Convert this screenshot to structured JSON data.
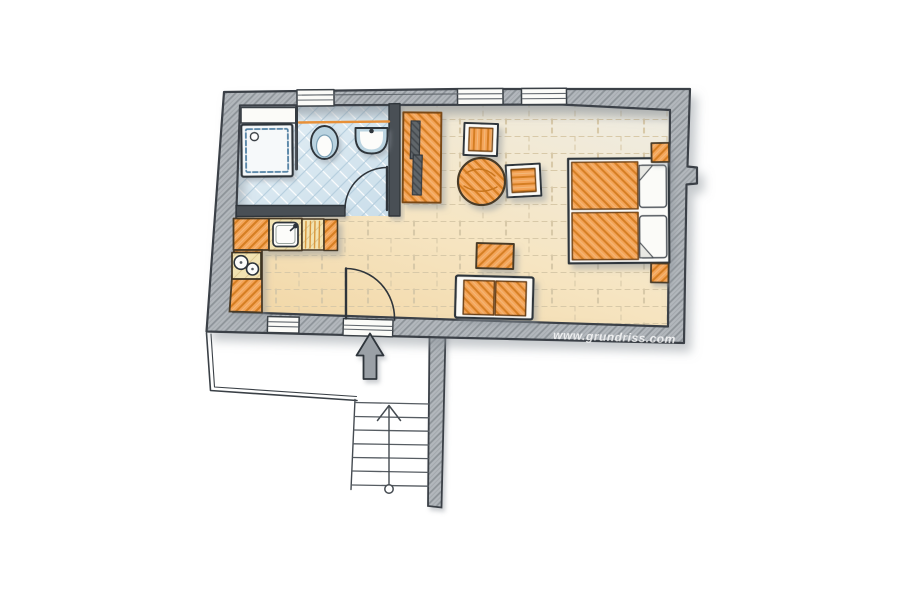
{
  "watermark": "www.grundriss.com",
  "palette": {
    "bg": "#ffffff",
    "wall-fill": "#b2b7bc",
    "wall-hatch": "#8d9398",
    "wall-hatch2": "#a4a9ae",
    "wall-outline": "#3a4046",
    "inner-wall": "#4a4f55",
    "line-dark": "#2f353b",
    "line-mid": "#61676d",
    "floor-light": "#efece1",
    "floor-mid": "#f6e5c2",
    "floor-warm": "#f2d8a8",
    "floor-line": "#d8c9a8",
    "bath-base-1": "#e6f0f6",
    "bath-base-2": "#cadeea",
    "bath-tile": "#b4cddd",
    "ceramic": "#fcfcfa",
    "ceramic-rim": "#bad3e0",
    "fixture-blue": "#4d7fa3",
    "accent": "#e89038",
    "orange": "#f4a458",
    "orange-hatch": "#d57e20",
    "orange-light": "#f3b879",
    "orange-outline": "#4a3a26",
    "pale-unit": "#f2e3b2",
    "pale-line": "#ddc891",
    "tv-dark": "#61666b",
    "tv-line": "#43484d",
    "white-furn": "#fbfbf8",
    "shadow": "#8d949b",
    "watermark-color": "#ffffff"
  },
  "plan": {
    "type": "hand-drawn apartment floor plan",
    "openings": {
      "windows": 4,
      "doors": 2
    },
    "rooms": [
      {
        "name": "bathroom",
        "fixtures": [
          "shower",
          "toilet",
          "washbasin",
          "wall-shelf",
          "glass-partition",
          "wall-rail",
          "door"
        ]
      },
      {
        "name": "kitchen",
        "fixtures": [
          "l-shaped-counter",
          "sink",
          "faucet",
          "drawer-unit",
          "cooktop-2-burners"
        ]
      },
      {
        "name": "living-sleeping-room",
        "furniture": [
          "tv-cabinet",
          "tv",
          "armchair",
          "armchair",
          "round-table",
          "coffee-table",
          "sofa-2-seats",
          "double-bed",
          "mattress",
          "mattress",
          "pillow",
          "pillow",
          "nightstand",
          "nightstand"
        ]
      }
    ],
    "exterior": {
      "elements": [
        "entrance-door",
        "entrance-arrow",
        "landing-with-railing",
        "staircase",
        "stair-side-wall"
      ],
      "staircase": {
        "treads": 7,
        "direction_marker": "circle-to-arrow"
      }
    }
  }
}
